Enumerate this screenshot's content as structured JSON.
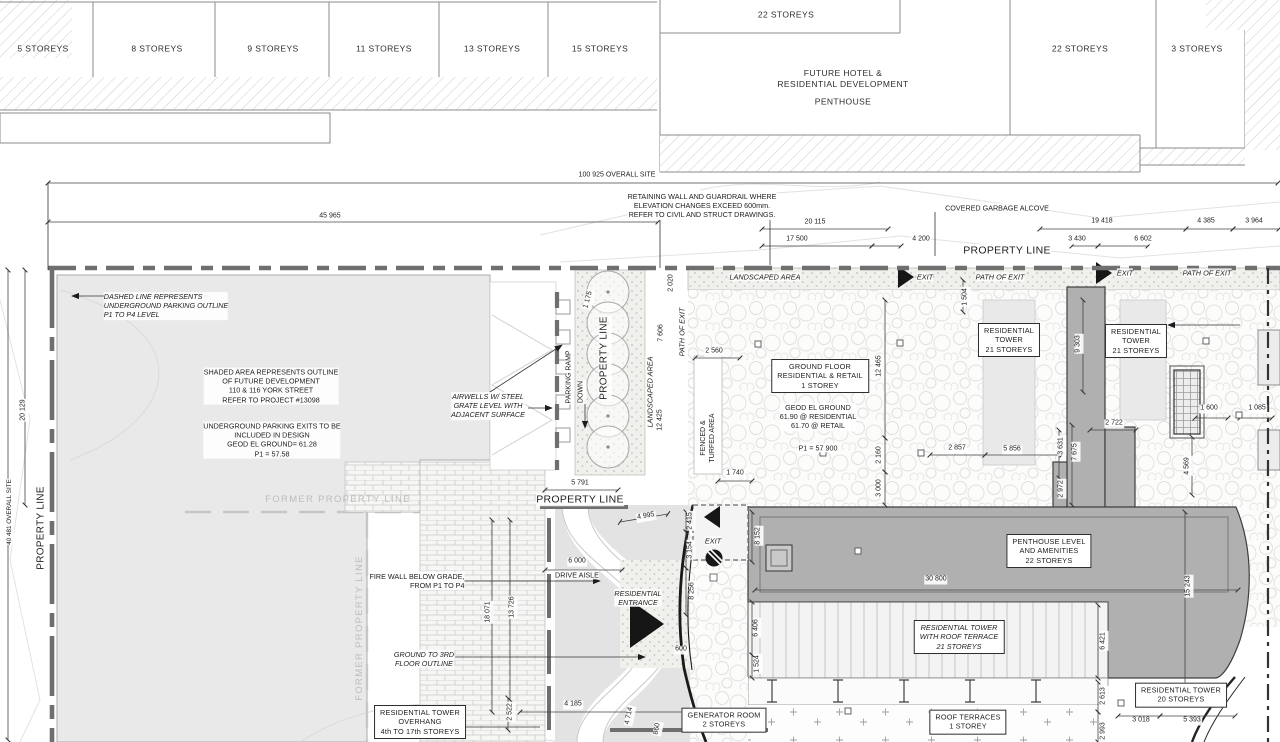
{
  "drawing_type": "architectural site plan",
  "colors": {
    "line": "#3f3f3f",
    "building_fill": "#b0b0b0",
    "shaded_future_area": "#e9e9e9",
    "heavy_property_line": "#6f6f6f",
    "former_property_line_text": "#bdbdbd",
    "paper": "#ffffff"
  },
  "top_band": {
    "labels": [
      {
        "t": "5 STOREYS",
        "x": 43,
        "y": 49,
        "s": "st"
      },
      {
        "t": "8 STOREYS",
        "x": 157,
        "y": 49,
        "s": "st"
      },
      {
        "t": "9 STOREYS",
        "x": 273,
        "y": 49,
        "s": "st"
      },
      {
        "t": "11 STOREYS",
        "x": 384,
        "y": 49,
        "s": "st"
      },
      {
        "t": "13 STOREYS",
        "x": 492,
        "y": 49,
        "s": "st"
      },
      {
        "t": "15 STOREYS",
        "x": 600,
        "y": 49,
        "s": "st"
      },
      {
        "t": "22 STOREYS",
        "x": 786,
        "y": 15,
        "s": "st"
      },
      {
        "t": "FUTURE HOTEL &\nRESIDENTIAL  DEVELOPMENT",
        "x": 843,
        "y": 79,
        "s": "st"
      },
      {
        "t": "PENTHOUSE",
        "x": 843,
        "y": 102,
        "s": "st"
      },
      {
        "t": "22 STOREYS",
        "x": 1080,
        "y": 49,
        "s": "st"
      },
      {
        "t": "3 STOREYS",
        "x": 1197,
        "y": 49,
        "s": "st"
      }
    ]
  },
  "dimension_band": {
    "labels": [
      {
        "t": "100 925 OVERALL SITE",
        "x": 617,
        "y": 176,
        "s": "d"
      },
      {
        "t": "45 965",
        "x": 330,
        "y": 217,
        "s": "d"
      },
      {
        "t": "RETAINING WALL AND GUARDRAIL WHERE\nELEVATION CHANGES EXCEED 600mm.\nREFER TO CIVIL AND STRUCT DRAWINGS.",
        "x": 702,
        "y": 206,
        "s": "n"
      },
      {
        "t": "COVERED GARBAGE ALCOVE",
        "x": 997,
        "y": 208,
        "s": "n"
      },
      {
        "t": "20 115",
        "x": 815,
        "y": 223,
        "s": "d"
      },
      {
        "t": "19 418",
        "x": 1102,
        "y": 222,
        "s": "d"
      },
      {
        "t": "4 385",
        "x": 1206,
        "y": 222,
        "s": "d"
      },
      {
        "t": "3 964",
        "x": 1254,
        "y": 222,
        "s": "d"
      },
      {
        "t": "17 500",
        "x": 797,
        "y": 240,
        "s": "d"
      },
      {
        "t": "4 200",
        "x": 921,
        "y": 240,
        "s": "d"
      },
      {
        "t": "3 430",
        "x": 1077,
        "y": 240,
        "s": "d"
      },
      {
        "t": "6 602",
        "x": 1143,
        "y": 240,
        "s": "d"
      },
      {
        "t": "PROPERTY LINE",
        "x": 1007,
        "y": 251,
        "s": "pl"
      }
    ]
  },
  "site_plan": {
    "labels": [
      {
        "t": "DASHED LINE REPRESENTS\nUNDERGROUND PARKING OUTLINE\nP1 TO P4 LEVEL",
        "x": 166,
        "y": 306,
        "s": "ni",
        "a": "left"
      },
      {
        "t": "SHADED AREA REPRESENTS OUTLINE\nOF FUTURE DEVELOPMENT\n110 & 116 YORK STREET\nREFER TO PROJECT #13098",
        "x": 271,
        "y": 386,
        "s": "n"
      },
      {
        "t": "UNDERGROUND PARKING EXITS TO BE\nINCLUDED IN DESIGN\nGEOD EL GROUND= 61.28\nP1 = 57.58",
        "x": 272,
        "y": 440,
        "s": "n"
      },
      {
        "t": "PROPERTY LINE",
        "x": 42,
        "y": 528,
        "r": -90,
        "s": "plv"
      },
      {
        "t": "40 481 OVERALL SITE",
        "x": 10,
        "y": 512,
        "r": -90,
        "s": "sm"
      },
      {
        "t": "20 129",
        "x": 24,
        "y": 410,
        "r": -90,
        "s": "d"
      },
      {
        "t": "FORMER PROPERTY LINE",
        "x": 338,
        "y": 500,
        "s": "g"
      },
      {
        "t": "FORMER PROPERTY LINE",
        "x": 360,
        "y": 628,
        "r": -90,
        "s": "g"
      },
      {
        "t": "AIRWELLS W/ STEEL\nGRATE LEVEL WITH\nADJACENT SURFACE",
        "x": 488,
        "y": 406,
        "s": "ni"
      },
      {
        "t": "PARKING RAMP",
        "x": 570,
        "y": 377,
        "r": -90,
        "s": "d"
      },
      {
        "t": "DOWN",
        "x": 582,
        "y": 392,
        "r": -90,
        "s": "d"
      },
      {
        "t": "PROPERTY LINE",
        "x": 605,
        "y": 358,
        "r": -90,
        "s": "plv"
      },
      {
        "t": "LANDSCAPED AREA",
        "x": 650,
        "y": 392,
        "r": -90,
        "s": "it"
      },
      {
        "t": "12 425",
        "x": 661,
        "y": 420,
        "r": -90,
        "s": "d"
      },
      {
        "t": "7 606",
        "x": 662,
        "y": 333,
        "r": -90,
        "s": "d"
      },
      {
        "t": "PATH OF EXIT",
        "x": 682,
        "y": 332,
        "r": -90,
        "s": "it"
      },
      {
        "t": "2 020",
        "x": 672,
        "y": 283,
        "r": -90,
        "s": "d"
      },
      {
        "t": "1 175",
        "x": 589,
        "y": 300,
        "r": -75,
        "s": "d"
      },
      {
        "t": "5 791",
        "x": 580,
        "y": 484,
        "s": "d"
      },
      {
        "t": "PROPERTY LINE",
        "x": 580,
        "y": 500,
        "s": "pl"
      },
      {
        "t": "4 995",
        "x": 646,
        "y": 517,
        "r": -10,
        "s": "d"
      },
      {
        "t": "2 415",
        "x": 691,
        "y": 521,
        "r": -90,
        "s": "d"
      },
      {
        "t": "3 154",
        "x": 691,
        "y": 550,
        "r": -90,
        "s": "d"
      },
      {
        "t": "8 256",
        "x": 693,
        "y": 591,
        "r": -90,
        "s": "d"
      },
      {
        "t": "6 000",
        "x": 577,
        "y": 562,
        "s": "d"
      },
      {
        "t": "DRIVE AISLE",
        "x": 577,
        "y": 575,
        "s": "n"
      },
      {
        "t": "RESIDENTIAL\nENTRANCE",
        "x": 638,
        "y": 598,
        "s": "ni"
      },
      {
        "t": "FIRE WALL BELOW GRADE,\nFROM P1 TO P4",
        "x": 417,
        "y": 581,
        "s": "n",
        "a": "right"
      },
      {
        "t": "GROUND TO 3RD\nFLOOR OUTLINE",
        "x": 424,
        "y": 659,
        "s": "ni"
      },
      {
        "t": "RESIDENTIAL TOWER\nOVERHANG\n4th TO 17th STOREYS",
        "x": 420,
        "y": 722,
        "s": "b"
      },
      {
        "t": "18 071",
        "x": 489,
        "y": 612,
        "r": -90,
        "s": "d"
      },
      {
        "t": "13 726",
        "x": 513,
        "y": 607,
        "r": -90,
        "s": "d"
      },
      {
        "t": "2 522",
        "x": 511,
        "y": 712,
        "r": -90,
        "s": "d"
      },
      {
        "t": "4 185",
        "x": 573,
        "y": 705,
        "s": "d"
      },
      {
        "t": "4 714",
        "x": 630,
        "y": 716,
        "r": -78,
        "s": "d"
      },
      {
        "t": "860",
        "x": 658,
        "y": 729,
        "r": -78,
        "s": "d"
      },
      {
        "t": "600",
        "x": 681,
        "y": 650,
        "s": "d"
      },
      {
        "t": "LANDSCAPED AREA",
        "x": 765,
        "y": 277,
        "s": "it"
      },
      {
        "t": "EXIT",
        "x": 925,
        "y": 277,
        "s": "it"
      },
      {
        "t": "PATH OF EXIT",
        "x": 1000,
        "y": 277,
        "s": "it"
      },
      {
        "t": "EXIT",
        "x": 1125,
        "y": 273,
        "s": "it"
      },
      {
        "t": "PATH OF EXIT",
        "x": 1207,
        "y": 273,
        "s": "it"
      },
      {
        "t": "2 560",
        "x": 714,
        "y": 352,
        "s": "d"
      },
      {
        "t": "GROUND FLOOR\nRESIDENTIAL & RETAIL\n1 STOREY",
        "x": 820,
        "y": 376,
        "s": "b"
      },
      {
        "t": "GEOD EL GROUND\n61.90 @ RESIDENTIAL\n61.70 @ RETAIL",
        "x": 818,
        "y": 417,
        "s": "n"
      },
      {
        "t": "P1 = 57 900",
        "x": 818,
        "y": 448,
        "s": "n"
      },
      {
        "t": "12 465",
        "x": 880,
        "y": 366,
        "r": -90,
        "s": "d"
      },
      {
        "t": "2 160",
        "x": 880,
        "y": 455,
        "r": -90,
        "s": "d"
      },
      {
        "t": "3 000",
        "x": 880,
        "y": 488,
        "r": -90,
        "s": "d"
      },
      {
        "t": "1 740",
        "x": 735,
        "y": 474,
        "s": "d"
      },
      {
        "t": "FENCED &\nTURFED AREA",
        "x": 709,
        "y": 438,
        "r": -90,
        "s": "d"
      },
      {
        "t": "1 504",
        "x": 966,
        "y": 297,
        "r": -90,
        "s": "d"
      },
      {
        "t": "RESIDENTIAL\nTOWER\n21 STOREYS",
        "x": 1009,
        "y": 340,
        "s": "b"
      },
      {
        "t": "RESIDENTIAL\nTOWER\n21 STOREYS",
        "x": 1136,
        "y": 341,
        "s": "b"
      },
      {
        "t": "9 303",
        "x": 1079,
        "y": 344,
        "r": -90,
        "s": "d"
      },
      {
        "t": "2 722",
        "x": 1114,
        "y": 424,
        "s": "d"
      },
      {
        "t": "3 631",
        "x": 1062,
        "y": 446,
        "r": -90,
        "s": "d"
      },
      {
        "t": "7 675",
        "x": 1076,
        "y": 452,
        "r": -90,
        "s": "d"
      },
      {
        "t": "2 972",
        "x": 1062,
        "y": 489,
        "r": -90,
        "s": "d"
      },
      {
        "t": "2 857",
        "x": 957,
        "y": 449,
        "s": "d"
      },
      {
        "t": "5 856",
        "x": 1012,
        "y": 450,
        "s": "d"
      },
      {
        "t": "1 600",
        "x": 1209,
        "y": 409,
        "s": "d"
      },
      {
        "t": "1 085",
        "x": 1257,
        "y": 409,
        "s": "d"
      },
      {
        "t": "4 569",
        "x": 1188,
        "y": 466,
        "r": -90,
        "s": "d"
      },
      {
        "t": "EXIT",
        "x": 713,
        "y": 541,
        "s": "it"
      },
      {
        "t": "8 152",
        "x": 759,
        "y": 536,
        "r": -90,
        "s": "d"
      },
      {
        "t": "30 800",
        "x": 936,
        "y": 580,
        "s": "d"
      },
      {
        "t": "PENTHOUSE LEVEL\nAND AMENITIES\n22 STOREYS",
        "x": 1049,
        "y": 551,
        "s": "b"
      },
      {
        "t": "15 243",
        "x": 1189,
        "y": 586,
        "r": -90,
        "s": "d"
      },
      {
        "t": "6 406",
        "x": 757,
        "y": 628,
        "r": -90,
        "s": "d"
      },
      {
        "t": "1 524",
        "x": 758,
        "y": 664,
        "r": -90,
        "s": "d"
      },
      {
        "t": "RESIDENTIAL TOWER\nWITH ROOF TERRACE\n21 STOREYS",
        "x": 959,
        "y": 637,
        "s": "bi"
      },
      {
        "t": "6 421",
        "x": 1104,
        "y": 641,
        "r": -90,
        "s": "d"
      },
      {
        "t": "2 613",
        "x": 1104,
        "y": 696,
        "r": -90,
        "s": "d"
      },
      {
        "t": "2 993",
        "x": 1104,
        "y": 731,
        "r": -90,
        "s": "d"
      },
      {
        "t": "GENERATOR ROOM\n2 STOREYS",
        "x": 724,
        "y": 720,
        "s": "b"
      },
      {
        "t": "ROOF TERRACES\n1 STOREY",
        "x": 968,
        "y": 722,
        "s": "b"
      },
      {
        "t": "RESIDENTIAL TOWER\n20 STOREYS",
        "x": 1181,
        "y": 695,
        "s": "b"
      },
      {
        "t": "3 018",
        "x": 1141,
        "y": 721,
        "s": "d"
      },
      {
        "t": "5 393",
        "x": 1192,
        "y": 721,
        "s": "d"
      }
    ]
  }
}
